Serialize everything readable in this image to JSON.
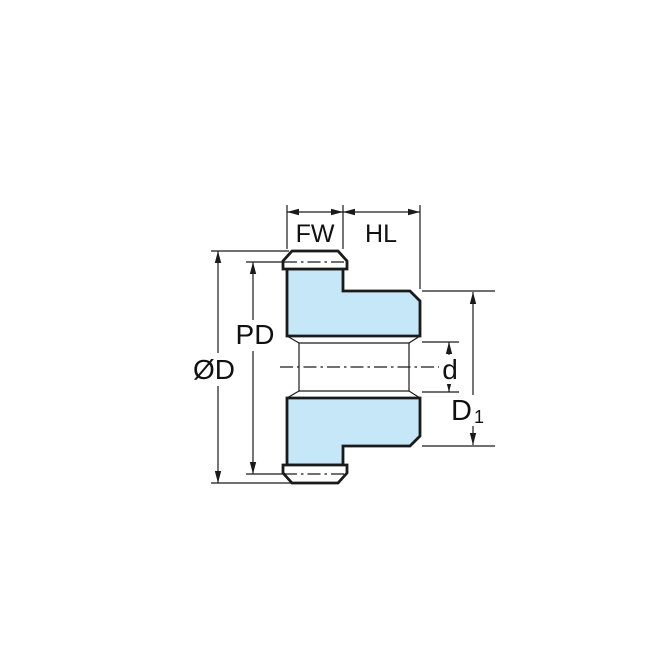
{
  "diagram": {
    "labels": {
      "face_width": "FW",
      "hub_length": "HL",
      "pitch_diameter": "PD",
      "outside_diameter": "ØD",
      "bore_diameter": "d",
      "hub_diameter_main": "D",
      "hub_diameter_sub": "1"
    },
    "colors": {
      "part_fill": "#C6E7F8",
      "tooth_fill": "#FFFFFF",
      "line": "#1A1A1A",
      "background": "#FFFFFF"
    }
  }
}
